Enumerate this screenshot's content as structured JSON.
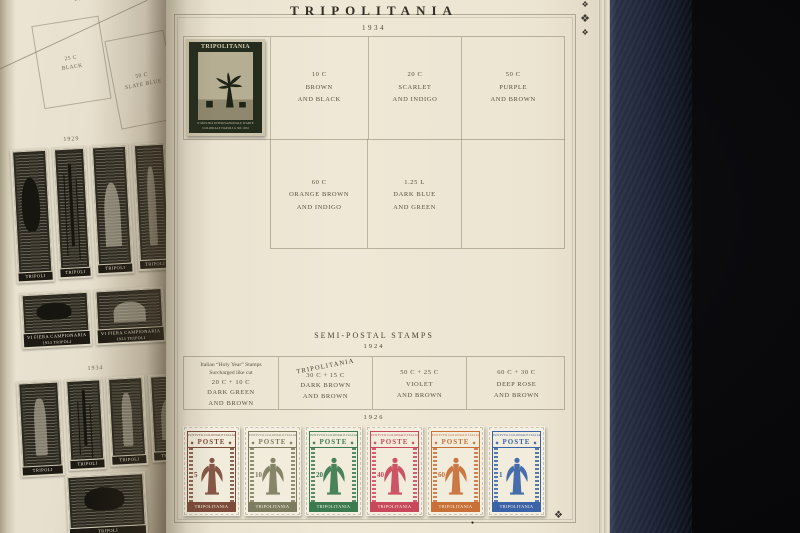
{
  "right_page": {
    "title": "TRIPOLITANIA",
    "year": "1934",
    "grid_1934": {
      "affixed_stamp": {
        "country": "TRIPOLITANIA",
        "side_text": "RR POSTE COLONIALI ITALIANE",
        "bottom_text": "II MOSTRA INTERNAZIONALE D'ARTE COLONIALE NAPOLI A·XII 1934",
        "ink_color": "#242c1e"
      },
      "row1_cells": [
        {
          "value": "10 C",
          "line1": "BROWN",
          "line2": "AND BLACK"
        },
        {
          "value": "20 C",
          "line1": "SCARLET",
          "line2": "AND INDIGO"
        },
        {
          "value": "50 C",
          "line1": "PURPLE",
          "line2": "AND BROWN"
        }
      ],
      "row2_cells": [
        {
          "value": "60 C",
          "line1": "ORANGE BROWN",
          "line2": "AND INDIGO"
        },
        {
          "value": "1.25 L",
          "line1": "DARK BLUE",
          "line2": "AND GREEN"
        }
      ]
    },
    "semi_postal": {
      "heading": "SEMI-POSTAL STAMPS",
      "year": "1924",
      "cells": [
        {
          "note1": "Italian “Holy Year” Stamps",
          "note2": "Surcharged like cut",
          "value": "20 C + 10 C",
          "line1": "DARK GREEN",
          "line2": "AND BROWN"
        },
        {
          "overprint": "TRIPOLITANIA",
          "value": "30 C + 15 C",
          "line1": "DARK BROWN",
          "line2": "AND BROWN"
        },
        {
          "value": "50 C + 25 C",
          "line1": "VIOLET",
          "line2": "AND BROWN"
        },
        {
          "value": "60 C + 30 C",
          "line1": "DEEP ROSE",
          "line2": "AND BROWN"
        }
      ]
    },
    "section_1926": {
      "year": "1926",
      "issuer_text": "ISTITVTO COLONIALE ITALIANO",
      "poste_label": "POSTE",
      "country_label": "TRIPOLITANIA",
      "stamps": [
        {
          "value": "5",
          "color": "#7d4b3a"
        },
        {
          "value": "10",
          "color": "#7e7c60"
        },
        {
          "value": "20",
          "color": "#3c7a50"
        },
        {
          "value": "40",
          "color": "#c8485c"
        },
        {
          "value": "60",
          "color": "#c96f38"
        },
        {
          "value": "1",
          "color": "#3a63a8"
        }
      ]
    },
    "ornaments": {
      "corner_glyph": "❖",
      "dot": "●"
    }
  },
  "left_page": {
    "top_year": "1888",
    "top_cells": [
      {
        "value": "25 C",
        "line1": "BLACK"
      },
      {
        "value": "50 C",
        "line1": "SLATE BLUE"
      }
    ],
    "caption_row1": "1929",
    "caption_row2": "1934",
    "tripoli_label": "TRIPOLI",
    "fair_line1": "VI FIERA CAMPIONARIA",
    "fair_line2": "1933 TRIPOLI"
  }
}
